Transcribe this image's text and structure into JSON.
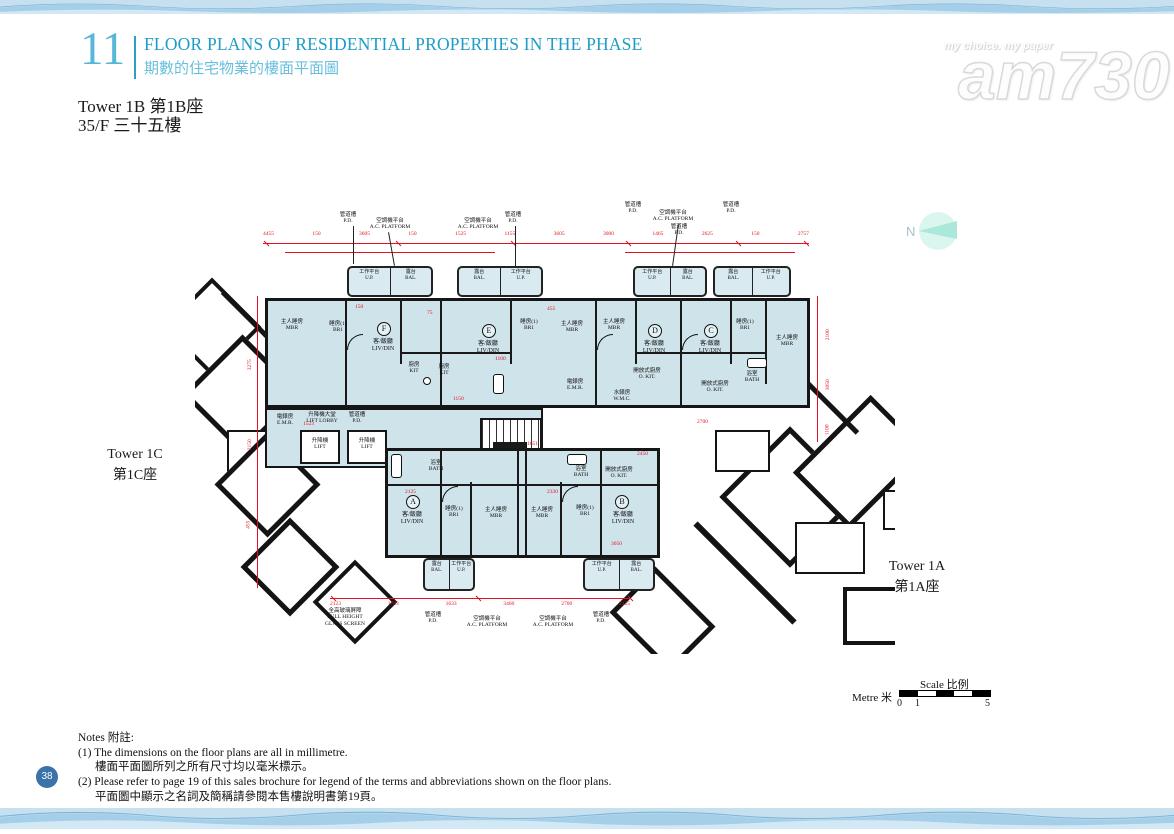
{
  "colors": {
    "accent_blue": "#2b9fc9",
    "subtitle_blue": "#67bfdd",
    "dimension_red": "#e01223",
    "room_fill": "#cfe3eb",
    "page_circle_blue": "#3b72a8",
    "north_teal": "#a9e6d8"
  },
  "header": {
    "section_number": "11",
    "title_en": "FLOOR PLANS OF RESIDENTIAL PROPERTIES IN THE PHASE",
    "title_zh": "期數的住宅物業的樓面平面圖"
  },
  "subheader": {
    "line1": "Tower 1B  第1B座",
    "line2": "35/F  三十五樓"
  },
  "watermark": {
    "tagline": "my choice. my paper",
    "logo": "am730"
  },
  "north": {
    "label": "N"
  },
  "plan": {
    "tower_1c_en": "Tower 1C",
    "tower_1c_zh": "第1C座",
    "tower_1a_en": "Tower 1A",
    "tower_1a_zh": "第1A座",
    "units": [
      "A",
      "B",
      "C",
      "D",
      "E",
      "F"
    ],
    "labels": {
      "liv_zh": "客/飯廳",
      "liv_en": "LIV/DIN",
      "mbr_zh": "主人睡房",
      "mbr_en": "MBR",
      "br1_zh": "睡房(1)",
      "br1_en": "BR1",
      "kit_zh": "廚房",
      "kit_en": "KIT",
      "okit_zh": "開放式廚房",
      "okit_en": "O. KIT.",
      "bath_zh": "浴室",
      "bath_en": "BATH",
      "bal_zh": "露台",
      "bal_en": "BAL.",
      "up_zh": "工作平台",
      "up_en": "U.P.",
      "pd_zh": "管道槽",
      "pd_en": "P.D.",
      "acp_zh": "空調機平台",
      "acp_en": "A.C. PLATFORM",
      "lift_zh": "升降機",
      "lift_en": "LIFT",
      "lobby_zh": "升降機大堂",
      "lobby_en": "LIFT LOBBY",
      "emr_zh": "電錶房",
      "emr_en": "E.M.R.",
      "wmc_zh": "水錶房",
      "wmc_en": "W.M.C.",
      "fhgs_zh": "全高玻璃屏障",
      "fhgs_en1": "FULL HEIGHT",
      "fhgs_en2": "GLASS SCREEN"
    },
    "dims_top": [
      "4455",
      "150",
      "3605",
      "150",
      "1525",
      "1155",
      "3605",
      "3000",
      "1465",
      "2625",
      "150",
      "2757"
    ],
    "dims_bottom": [
      "2123",
      "1783",
      "1633",
      "3460",
      "2700",
      "2125"
    ],
    "dims_left": [
      "3275",
      "2150",
      "455"
    ],
    "dims_right": [
      "2100",
      "3050",
      "1100"
    ],
    "dims_scatter": [
      "150",
      "75",
      "455",
      "1100",
      "1150",
      "1523",
      "1651",
      "2125",
      "2330",
      "2450",
      "2700",
      "3050"
    ]
  },
  "scale_bar": {
    "title": "Scale 比例",
    "unit": "Metre 米",
    "tick0": "0",
    "tick1": "1",
    "tick5": "5"
  },
  "notes": {
    "heading": "Notes 附註:",
    "lines": [
      "(1) The dimensions on the floor plans are all in millimetre.",
      "樓面平面圖所列之所有尺寸均以毫米標示。",
      "(2) Please refer to page 19 of this sales brochure for legend of the terms and abbreviations shown on the floor plans.",
      "平面圖中顯示之名詞及簡稱請參閱本售樓說明書第19頁。"
    ]
  },
  "page_number": "38"
}
